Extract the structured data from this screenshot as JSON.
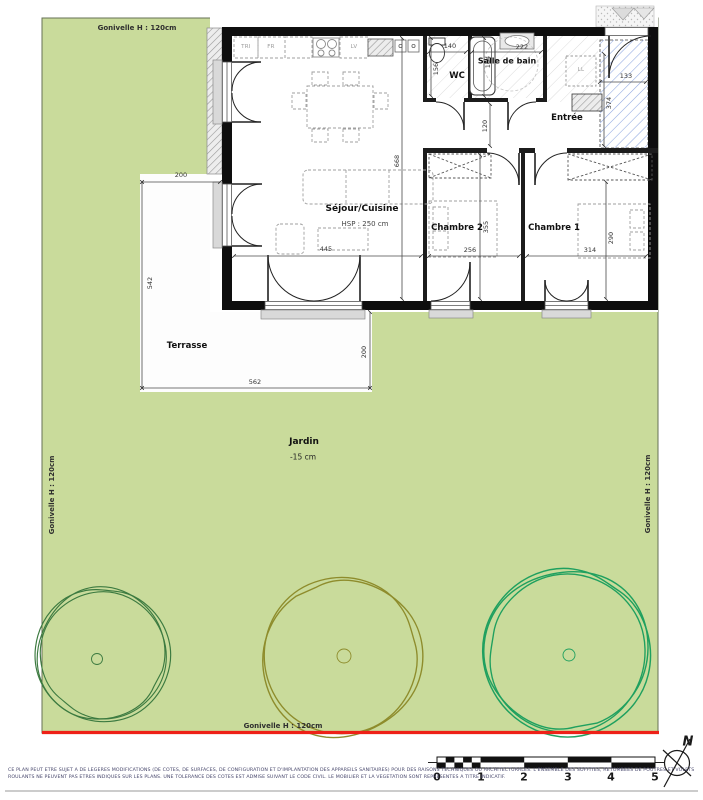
{
  "garden": {
    "fence_label": "Gonivelle H : 120cm",
    "name": "Jardin",
    "level": "-15 cm"
  },
  "rooms": {
    "sejour": {
      "name": "Séjour/Cuisine",
      "ceiling_height": "HSP : 250 cm",
      "dim_width": "445",
      "dim_height": "668"
    },
    "wc": {
      "name": "WC",
      "dim_width": "140",
      "dim_height": "156"
    },
    "salle_de_bain": {
      "name": "Salle de bain",
      "dim_width": "222",
      "dim_height": "164"
    },
    "entree": {
      "name": "Entrée",
      "dim_width": "133",
      "dim_height": "374",
      "dim_hall": "120"
    },
    "chambre2": {
      "name": "Chambre 2",
      "dim_width": "256",
      "dim_height": "355"
    },
    "chambre1": {
      "name": "Chambre 1",
      "dim_width": "314",
      "dim_height": "290"
    },
    "terrasse": {
      "name": "Terrasse",
      "dim_top": "200",
      "dim_left": "542",
      "dim_bottom": "562",
      "dim_right": "200"
    }
  },
  "appliances": {
    "tri": "TRI",
    "fr": "FR",
    "lv": "LV",
    "ll": "LL"
  },
  "scale_bar": {
    "ticks": [
      "0",
      "1",
      "2",
      "3",
      "4",
      "5"
    ]
  },
  "compass": {
    "north": "N"
  },
  "disclaimer": {
    "line1": "CE PLAN PEUT ETRE SUJET A DE LEGERES MODIFICATIONS (DE COTES, DE SURFACES, DE CONFIGURATION ET D'IMPLANTATION DES APPAREILS SANITAIRES) POUR DES RAISONS TECHNIQUES OU ARCHITECTURALES. L'ENSEMBLE DES SOFFITES, RETOMBEES DE POUTRES ET VOLETS",
    "line2": "ROULANTS NE PEUVENT PAS ETRES INDIQUES SUR LES PLANS. UNE TOLERANCE DES COTES EST ADMISE SUIVANT LE CODE CIVIL. LE MOBILIER ET LA VEGETATION SONT REPRESENTES A TITRE INDICATIF."
  },
  "colors": {
    "garden_green": "#c9db9b",
    "tree_dark_green": "#3c7a40",
    "tree_olive": "#8e8c2c",
    "tree_bright_green": "#1fa05f",
    "boundary_red": "#ee2118",
    "access_hatch_blue": "#8ea6e0"
  }
}
